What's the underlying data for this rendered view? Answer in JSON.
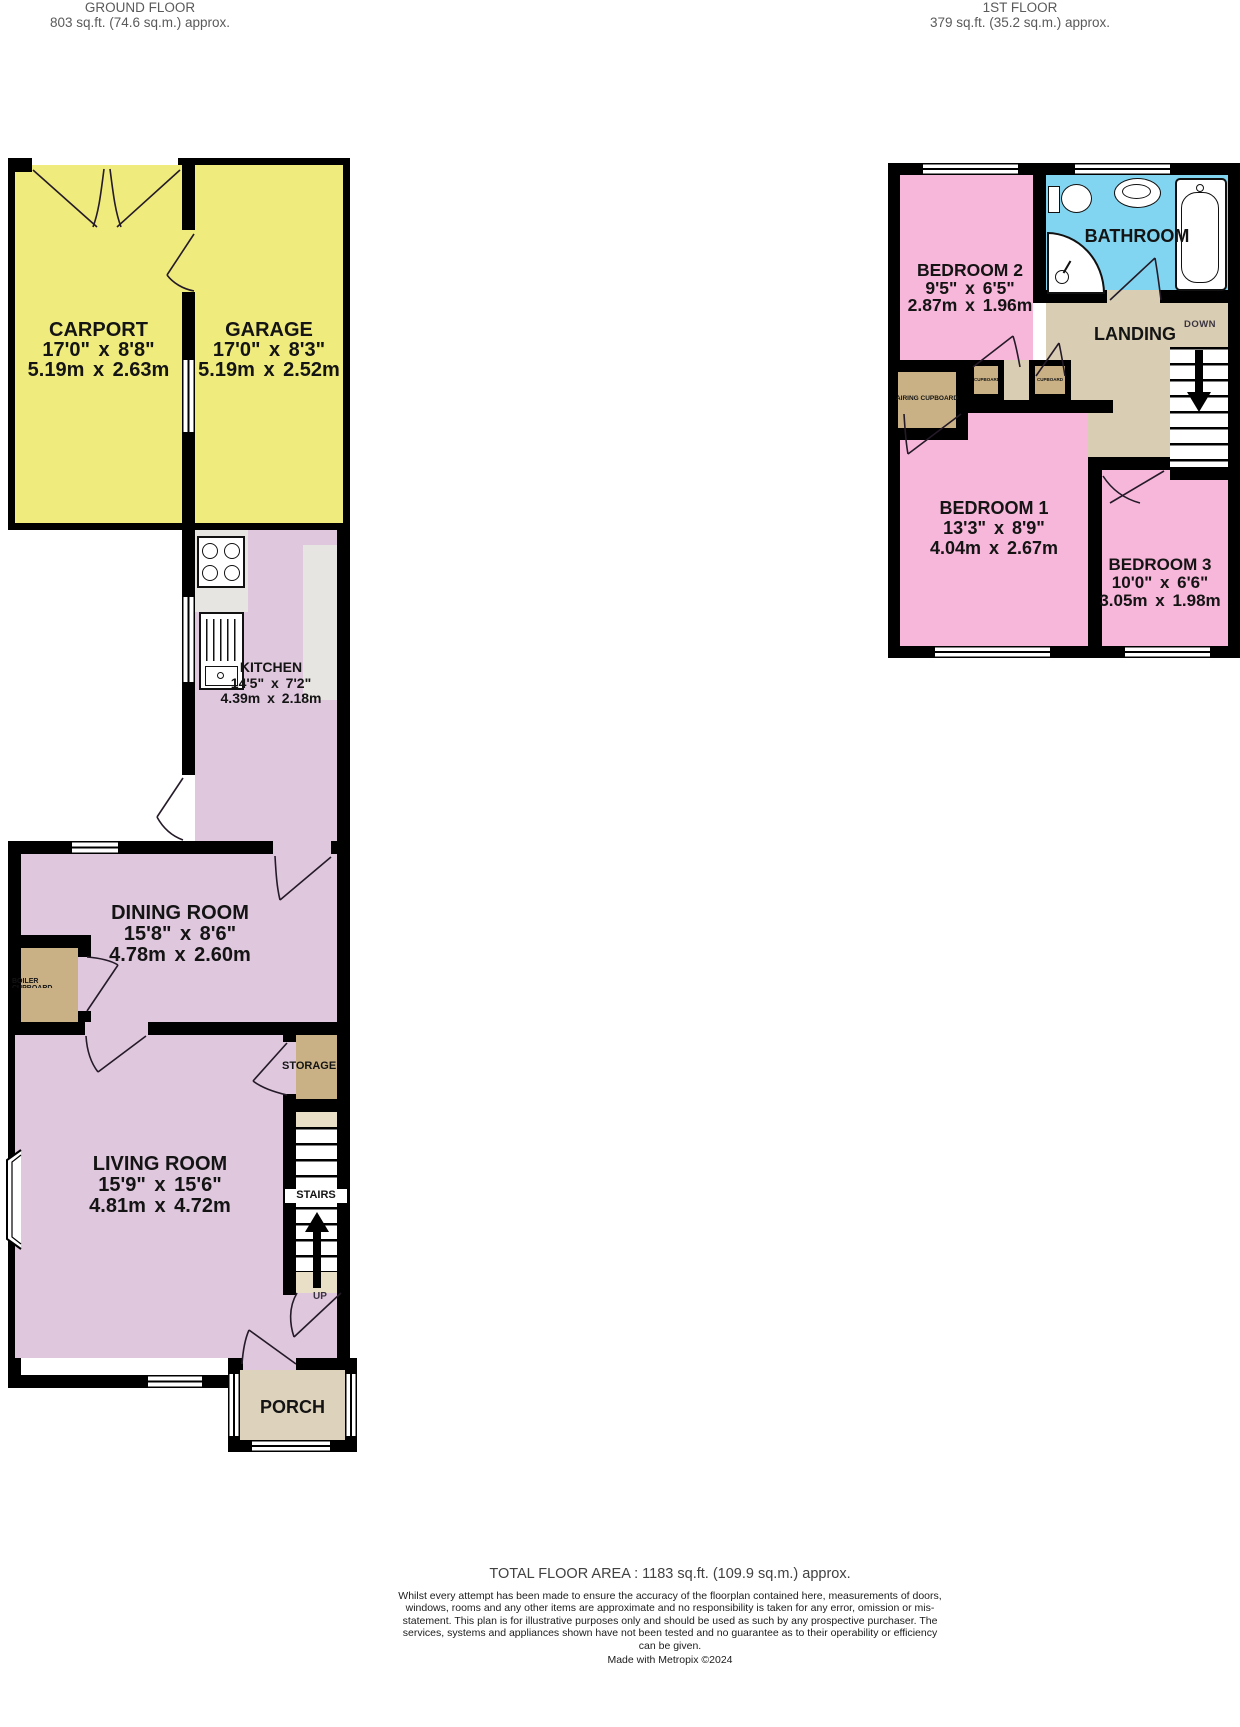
{
  "headers": {
    "ground_floor": {
      "line1": "GROUND FLOOR",
      "line2": "803 sq.ft. (74.6 sq.m.) approx."
    },
    "first_floor": {
      "line1": "1ST FLOOR",
      "line2": "379 sq.ft. (35.2 sq.m.) approx."
    }
  },
  "ground_floor": {
    "carport": {
      "name": "CARPORT",
      "imperial": "17'0\" x 8'8\"",
      "metric": "5.19m x 2.63m"
    },
    "garage": {
      "name": "GARAGE",
      "imperial": "17'0\" x 8'3\"",
      "metric": "5.19m x 2.52m"
    },
    "kitchen": {
      "name": "KITCHEN",
      "imperial": "14'5\" x 7'2\"",
      "metric": "4.39m x 2.18m"
    },
    "dining_room": {
      "name": "DINING ROOM",
      "imperial": "15'8\" x 8'6\"",
      "metric": "4.78m x 2.60m"
    },
    "living_room": {
      "name": "LIVING ROOM",
      "imperial": "15'9\" x 15'6\"",
      "metric": "4.81m x 4.72m"
    },
    "boiler_cupboard": {
      "name": "BOILER CUPBOARD"
    },
    "storage": {
      "name": "STORAGE"
    },
    "stairs": {
      "name": "STAIRS",
      "direction": "UP"
    },
    "porch": {
      "name": "PORCH"
    }
  },
  "first_floor": {
    "bedroom_2": {
      "name": "BEDROOM 2",
      "imperial": "9'5\" x 6'5\"",
      "metric": "2.87m x 1.96m"
    },
    "bathroom": {
      "name": "BATHROOM"
    },
    "landing": {
      "name": "LANDING",
      "direction": "DOWN"
    },
    "airing_cupboard": {
      "name": "AIRING CUPBOARD"
    },
    "cupboard_left": {
      "name": "CUPBOARD"
    },
    "cupboard_right": {
      "name": "CUPBOARD"
    },
    "bedroom_1": {
      "name": "BEDROOM 1",
      "imperial": "13'3\" x 8'9\"",
      "metric": "4.04m x 2.67m"
    },
    "bedroom_3": {
      "name": "BEDROOM 3",
      "imperial": "10'0\" x 6'6\"",
      "metric": "3.05m x 1.98m"
    }
  },
  "footer": {
    "total_area": "TOTAL FLOOR AREA : 1183 sq.ft. (109.9 sq.m.) approx.",
    "disclaimer": "Whilst every attempt has been made to ensure the accuracy of the floorplan contained here, measurements of doors, windows, rooms and any other items are approximate and no responsibility is taken for any error, omission or mis-statement. This plan is for illustrative purposes only and should be used as such by any prospective purchaser. The services, systems and appliances shown have not been tested and no guarantee as to their operability or efficiency can be given.",
    "credit": "Made with Metropix ©2024"
  },
  "colors": {
    "garage_yellow": "#EFEB7C",
    "ground_room_mauve": "#DFC7DD",
    "bedroom_pink": "#F7B7DA",
    "bathroom_blue": "#82D5F0",
    "cupboard_tan": "#C9B185",
    "landing_beige": "#D9CDB3",
    "porch_beige": "#DDD3BC",
    "stair_strip_beige": "#E8DFC6",
    "counter_grey": "#E7E5E2",
    "wall": "#000000"
  }
}
